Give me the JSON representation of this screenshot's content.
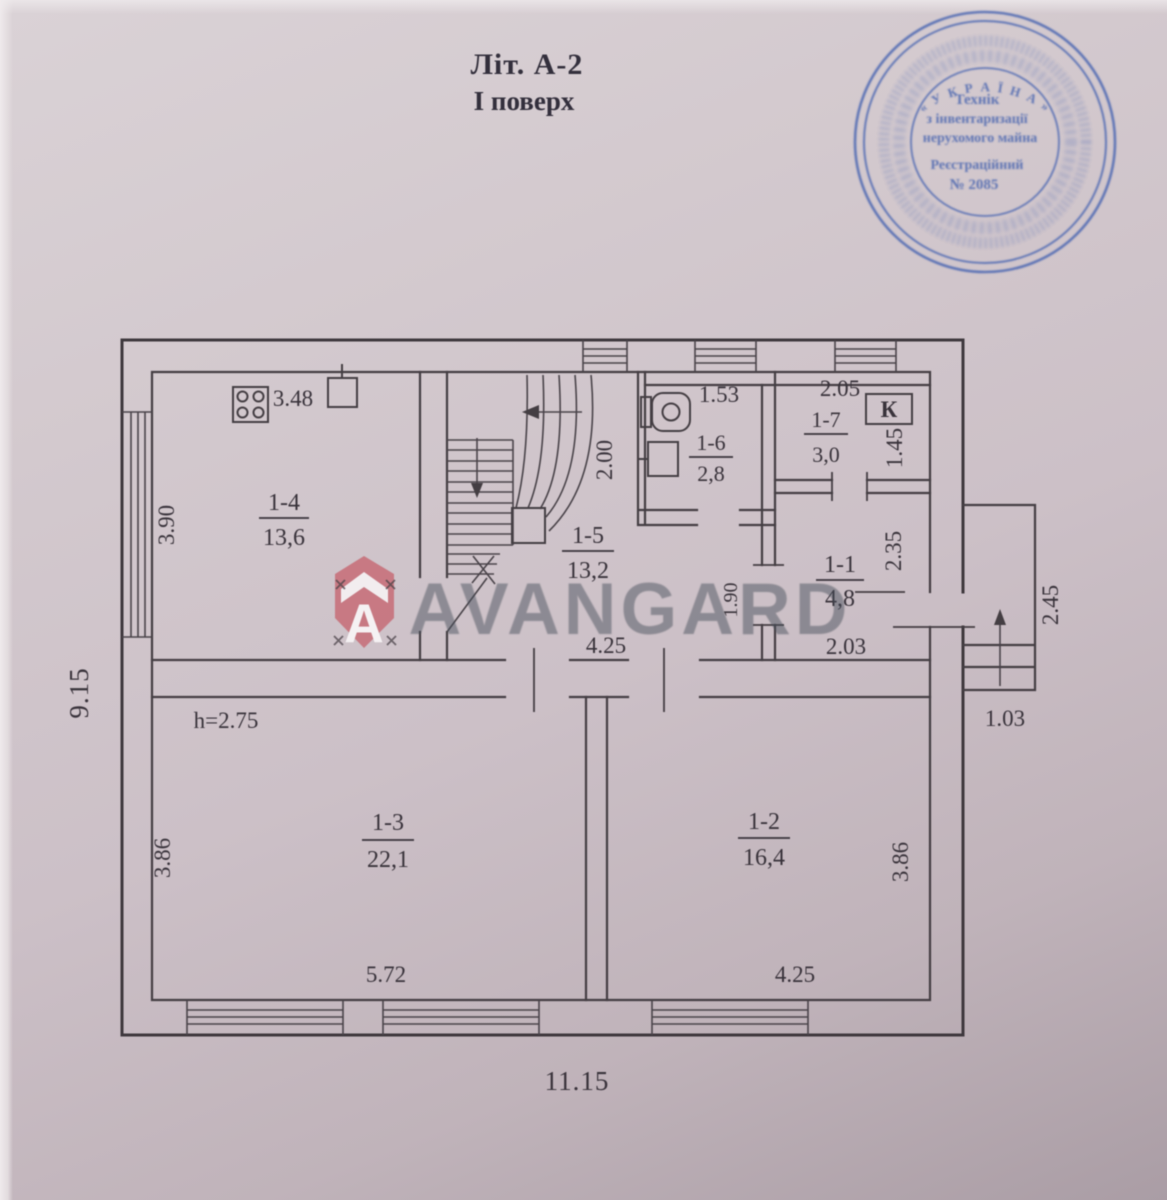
{
  "title": {
    "line1": "Літ. А-2",
    "line2": "І поверх"
  },
  "stamp": {
    "color": "#4c67b0",
    "ring_top": "« У К Р А Ї Н А »",
    "line1": "Технік",
    "line2": "з інвентаризації",
    "line3": "нерухомого майна",
    "line4": "Реєстраційний",
    "line5": "№ 2085"
  },
  "watermark": {
    "brand": "AVANGARD",
    "shield_letter": "А",
    "shield_color": "#c7707a",
    "text_color": "#49515c"
  },
  "rooms": {
    "r11": {
      "number": "1-1",
      "area": "4,8"
    },
    "r12": {
      "number": "1-2",
      "area": "16,4"
    },
    "r13": {
      "number": "1-3",
      "area": "22,1"
    },
    "r14": {
      "number": "1-4",
      "area": "13,6"
    },
    "r15": {
      "number": "1-5",
      "area": "13,2"
    },
    "r16": {
      "number": "1-6",
      "area": "2,8"
    },
    "r17": {
      "number": "1-7",
      "area": "3,0"
    }
  },
  "dims": {
    "room14_top": "3.48",
    "room14_left": "3.90",
    "outer_left": "9.15",
    "room16_top": "1.53",
    "room16_left": "2.00",
    "room17_top": "2.05",
    "room17_right": "1.45",
    "room11_right": "2.35",
    "room11_bottom": "2.03",
    "hall_wall": "1.90",
    "hall_bottom": "4.25",
    "ceiling_height": "h=2.75",
    "room13_left": "3.86",
    "room13_bottom": "5.72",
    "room12_right": "3.86",
    "room12_bottom": "4.25",
    "outer_bottom": "11.15",
    "porch_right": "2.45",
    "porch_bottom": "1.03"
  },
  "fixtures": {
    "boiler_label": "К"
  }
}
